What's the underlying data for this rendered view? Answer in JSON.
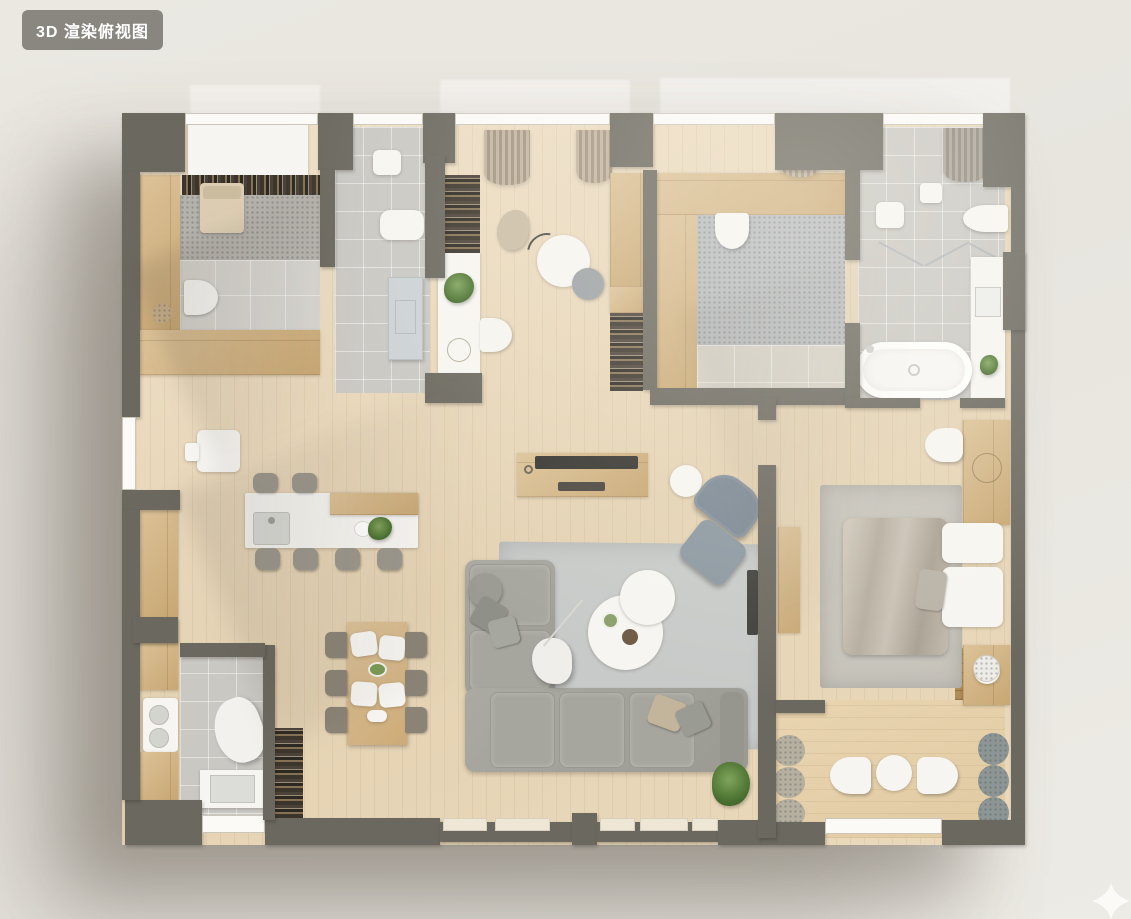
{
  "overlay": {
    "view_label": "3D 渲染俯视图"
  },
  "watermark": {
    "icon": "sparkle-icon"
  },
  "palette": {
    "badgeBg": "rgba(128,126,119,0.92)",
    "badgeText": "#ffffff",
    "wall": "#6b685f",
    "tile": "#cac8c3",
    "tileLight": "#d6d4cf",
    "carpet": "#b5b2ac",
    "rugLiving": "#c7cac8",
    "rugBedroom": "#c6c3bb",
    "rugSpeckle": "#b6b9bc",
    "accentChair": "#7b8894",
    "ottoman": "#8b97a0",
    "doorBlue": "#ccd2d5",
    "chairGray": "#8a8376",
    "stool": "#9b978c",
    "poufBeige": "#b6b0a0",
    "poufGray": "#8d9694",
    "woodDark": "#b28e60"
  },
  "floorplan": {
    "style": "3d-top-down-render",
    "rooms": [
      {
        "name": "small-bedroom",
        "furniture": [
          "closet",
          "bookshelf",
          "single-bed",
          "wardrobe",
          "counter",
          "toilet",
          "basket"
        ]
      },
      {
        "name": "entry-hall",
        "furniture": [
          "door-mat",
          "shoe-bench",
          "entry-door"
        ]
      },
      {
        "name": "study",
        "furniture": [
          "curtains",
          "bookshelves",
          "desk",
          "desk-chair",
          "round-table",
          "task-chair",
          "beanbag",
          "arc-lamp",
          "wardrobe"
        ]
      },
      {
        "name": "kids-room",
        "furniture": [
          "wood-platform",
          "desk-chair",
          "area-rug",
          "curtain",
          "floor-tiles"
        ]
      },
      {
        "name": "main-bathroom",
        "furniture": [
          "shower-curtain",
          "hand-basin",
          "shower-mat",
          "wall-hung-toilet",
          "glass-screens",
          "vanity",
          "bathtub",
          "plant"
        ]
      },
      {
        "name": "master-bedroom",
        "furniture": [
          "headboard-panel",
          "stool",
          "area-rug",
          "double-bed",
          "pillows",
          "nightstand",
          "console-desk",
          "wall-tv"
        ]
      },
      {
        "name": "kitchen",
        "furniture": [
          "wall-cabinets",
          "coffee-station",
          "island-counter",
          "island-sink",
          "bar-stools",
          "plant"
        ]
      },
      {
        "name": "dining-area",
        "furniture": [
          "dining-table",
          "dining-chairs",
          "plates",
          "serving-bowl",
          "bookshelf"
        ]
      },
      {
        "name": "laundry-bathroom",
        "furniture": [
          "cabinets",
          "washer",
          "lounge-chair",
          "sink-counter"
        ]
      },
      {
        "name": "living-room",
        "furniture": [
          "tv-console",
          "tv",
          "side-table",
          "accent-chair",
          "ottoman",
          "area-rug",
          "corner-sofa",
          "pouf",
          "pillows",
          "coffee-tables",
          "floor-lamp",
          "plant"
        ]
      },
      {
        "name": "balcony-lounge",
        "furniture": [
          "poufs",
          "lounge-chairs",
          "round-table",
          "marble-side-table",
          "dark-wood-deck"
        ]
      }
    ]
  }
}
